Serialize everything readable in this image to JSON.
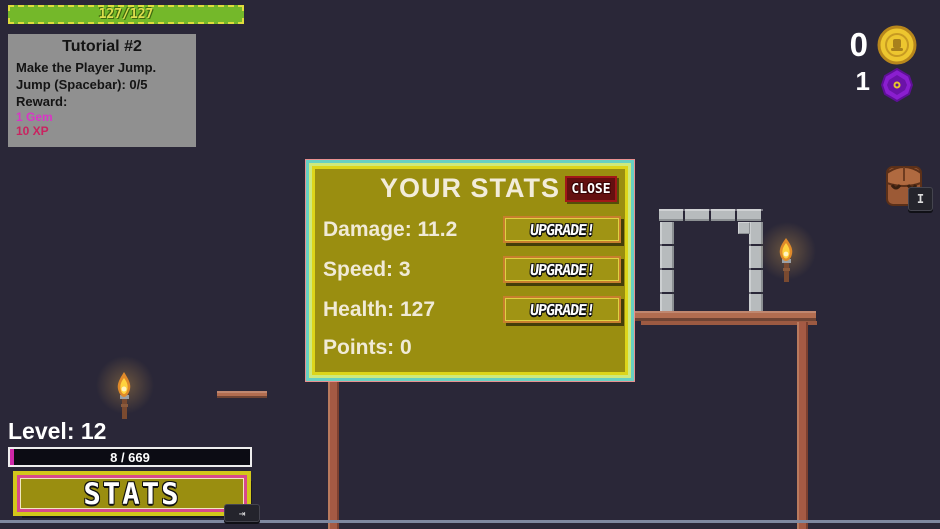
{
  "hud": {
    "health_bar": {
      "value": "127/127"
    },
    "currency": {
      "coin_count": "0",
      "gem_count": "1"
    },
    "level_label": "Level: 12",
    "xp_bar": {
      "value": "8 / 669"
    },
    "stats_button_label": "STATS",
    "key_hints": {
      "inventory": "I",
      "stats": "⇥"
    }
  },
  "tutorial": {
    "title": "Tutorial #2",
    "lines": [
      "Make the Player Jump.",
      "Jump (Spacebar): 0/5",
      "Reward:"
    ],
    "rewards": [
      {
        "text": "1 Gem",
        "color": "#d936c6"
      },
      {
        "text": "10 XP",
        "color": "#c92360"
      }
    ]
  },
  "stats_panel": {
    "title": "YOUR STATS",
    "close_label": "CLOSE",
    "rows": [
      {
        "label": "Damage: 11.2",
        "has_upgrade": true
      },
      {
        "label": "Speed: 3",
        "has_upgrade": true
      },
      {
        "label": "Health: 127",
        "has_upgrade": true
      },
      {
        "label": "Points: 0",
        "has_upgrade": false
      }
    ],
    "upgrade_label": "UPGRADE!"
  },
  "icons": {
    "coin-icon": "gold coin (circle)",
    "gem-icon": "purple gem (hexagon with yellow dot)",
    "backpack-icon": "brown backpack",
    "torch-icon": "lit wall torch",
    "tab-key-icon": "⇥",
    "inventory-key-icon": "I"
  },
  "colors": {
    "background": "#2a2738",
    "panel_olive": "#9a8e10",
    "panel_border_teal": "#68d0c2",
    "panel_border_green": "#cee97d",
    "panel_border_yellow": "#ddd51a",
    "health_green": "#74b82a",
    "xp_magenta": "#cf28a8",
    "stats_button_pink": "#d8488c",
    "close_red": "#641010",
    "upgrade_orange": "#c87f2d",
    "wood": "#b26d50",
    "stone": "#b7bbbd"
  }
}
